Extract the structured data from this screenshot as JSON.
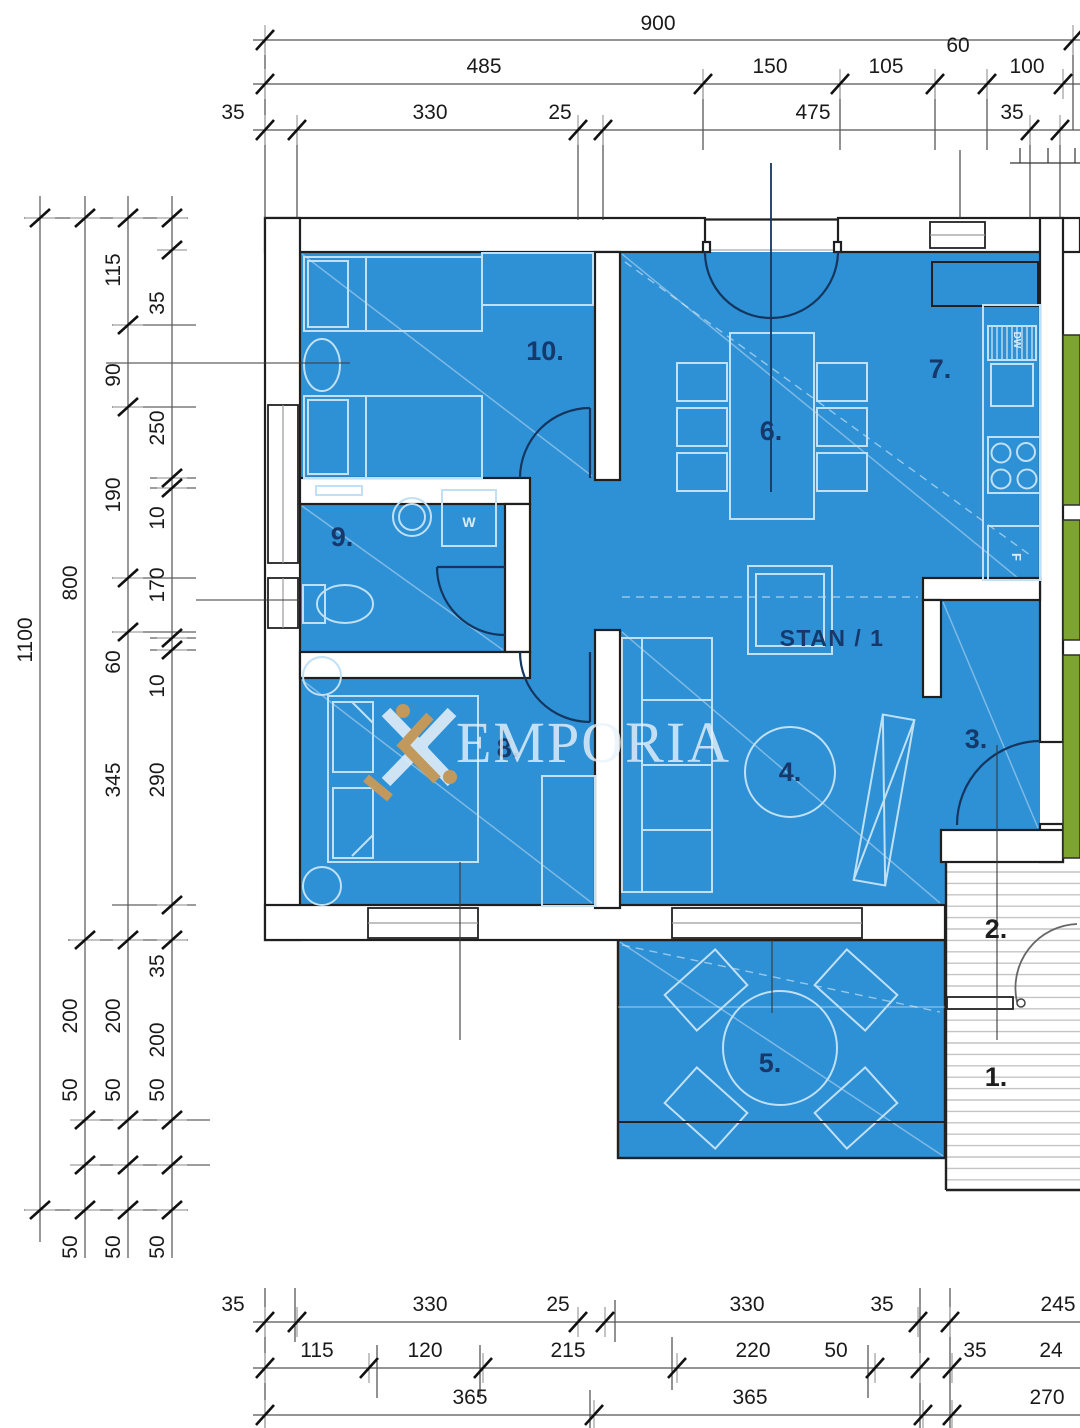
{
  "unit_label": {
    "text": "STAN / 1"
  },
  "watermark": {
    "text": "EMPORIA"
  },
  "room_labels": [
    {
      "num": "1.",
      "x": 996,
      "y": 1086,
      "color": "dark"
    },
    {
      "num": "2.",
      "x": 996,
      "y": 938,
      "color": "dark"
    },
    {
      "num": "3.",
      "x": 976,
      "y": 748,
      "color": "navy"
    },
    {
      "num": "4.",
      "x": 790,
      "y": 781,
      "color": "navy"
    },
    {
      "num": "5.",
      "x": 770,
      "y": 1072,
      "color": "navy"
    },
    {
      "num": "6.",
      "x": 771,
      "y": 440,
      "color": "navy"
    },
    {
      "num": "7.",
      "x": 940,
      "y": 378,
      "color": "navy"
    },
    {
      "num": "8.",
      "x": 508,
      "y": 757,
      "color": "navy"
    },
    {
      "num": "9.",
      "x": 342,
      "y": 546,
      "color": "navy"
    },
    {
      "num": "10.",
      "x": 545,
      "y": 360,
      "color": "navy"
    }
  ],
  "fixture_labels": [
    {
      "t": "W",
      "x": 469,
      "y": 527,
      "rot": 0,
      "size": 14
    },
    {
      "t": "DW",
      "x": 1014,
      "y": 340,
      "rot": 90,
      "size": 10
    },
    {
      "t": "F",
      "x": 1012,
      "y": 557,
      "rot": 90,
      "size": 13
    }
  ],
  "colors": {
    "room_blue": "#2E90D5",
    "label_navy": "#16386B",
    "label_dark": "#1E1E1E",
    "neighbor_green": "#7CA42F",
    "logo_orange": "#CE9A52"
  },
  "dims": {
    "top_rows": [
      {
        "y": 40,
        "line": [
          253,
          1080
        ],
        "ticks": [
          265,
          1073
        ],
        "labels": [
          {
            "t": "900",
            "x": 658,
            "dy": -10
          }
        ]
      },
      {
        "y": 84,
        "line": [
          253,
          1080
        ],
        "ticks": [
          265,
          703,
          840,
          935,
          987,
          1063
        ],
        "labels": [
          {
            "t": "485",
            "x": 484,
            "dy": -11
          },
          {
            "t": "150",
            "x": 770,
            "dy": -11
          },
          {
            "t": "105",
            "x": 886,
            "dy": -11
          },
          {
            "t": "60",
            "x": 958,
            "dy": -32
          },
          {
            "t": "100",
            "x": 1027,
            "dy": -11
          }
        ]
      },
      {
        "y": 130,
        "line": [
          253,
          1080
        ],
        "ticks": [
          265,
          297,
          578,
          603,
          1030,
          1060
        ],
        "labels": [
          {
            "t": "35",
            "x": 233,
            "dy": -11
          },
          {
            "t": "330",
            "x": 430,
            "dy": -11
          },
          {
            "t": "25",
            "x": 560,
            "dy": -11
          },
          {
            "t": "475",
            "x": 813,
            "dy": -11
          },
          {
            "t": "35",
            "x": 1012,
            "dy": -11
          }
        ]
      }
    ],
    "left_cols": [
      {
        "x": 40,
        "line": [
          196,
          1242
        ],
        "ticks": [
          218,
          1210
        ],
        "labels": [
          {
            "t": "1100",
            "y": 640
          }
        ]
      },
      {
        "x": 85,
        "line": [
          196,
          1258
        ],
        "ticks": [
          218,
          940,
          1120,
          1165,
          1210
        ],
        "labels": [
          {
            "t": "800",
            "y": 583
          },
          {
            "t": "200",
            "y": 1016
          },
          {
            "t": "50",
            "y": 1090
          },
          {
            "t": "50",
            "y": 1247
          }
        ]
      },
      {
        "x": 128,
        "line": [
          196,
          1258
        ],
        "ticks": [
          218,
          325,
          407,
          578,
          632,
          940,
          1120,
          1165,
          1210
        ],
        "labels": [
          {
            "t": "115",
            "y": 270
          },
          {
            "t": "90",
            "y": 375
          },
          {
            "t": "190",
            "y": 495
          },
          {
            "t": "60",
            "y": 662
          },
          {
            "t": "345",
            "y": 780
          },
          {
            "t": "200",
            "y": 1016
          },
          {
            "t": "50",
            "y": 1090
          },
          {
            "t": "50",
            "y": 1247
          }
        ]
      },
      {
        "x": 172,
        "line": [
          196,
          1258
        ],
        "ticks": [
          218,
          250,
          478,
          488,
          638,
          650,
          905,
          940,
          1120,
          1165,
          1210
        ],
        "labels": [
          {
            "t": "35",
            "y": 303
          },
          {
            "t": "250",
            "y": 428
          },
          {
            "t": "10",
            "y": 518
          },
          {
            "t": "170",
            "y": 585
          },
          {
            "t": "10",
            "y": 686
          },
          {
            "t": "290",
            "y": 780
          },
          {
            "t": "35",
            "y": 966
          },
          {
            "t": "200",
            "y": 1040
          },
          {
            "t": "50",
            "y": 1090
          },
          {
            "t": "50",
            "y": 1247
          }
        ]
      }
    ],
    "bottom_rows": [
      {
        "y": 1322,
        "line": [
          253,
          1080
        ],
        "ticks": [
          265,
          297,
          578,
          605,
          918,
          950
        ],
        "labels": [
          {
            "t": "35",
            "x": 233,
            "dy": -11
          },
          {
            "t": "330",
            "x": 430,
            "dy": -11
          },
          {
            "t": "25",
            "x": 558,
            "dy": -11
          },
          {
            "t": "330",
            "x": 747,
            "dy": -11
          },
          {
            "t": "35",
            "x": 882,
            "dy": -11
          },
          {
            "t": "245",
            "x": 1058,
            "dy": -11
          }
        ]
      },
      {
        "y": 1368,
        "line": [
          253,
          1080
        ],
        "ticks": [
          265,
          369,
          483,
          677,
          875,
          920,
          952
        ],
        "labels": [
          {
            "t": "115",
            "x": 317,
            "dy": -11
          },
          {
            "t": "120",
            "x": 425,
            "dy": -11
          },
          {
            "t": "215",
            "x": 568,
            "dy": -11
          },
          {
            "t": "220",
            "x": 753,
            "dy": -11
          },
          {
            "t": "50",
            "x": 836,
            "dy": -11
          },
          {
            "t": "35",
            "x": 975,
            "dy": -11
          },
          {
            "t": "24",
            "x": 1051,
            "dy": -11
          }
        ]
      },
      {
        "y": 1415,
        "line": [
          253,
          1080
        ],
        "ticks": [
          265,
          594,
          923,
          952
        ],
        "labels": [
          {
            "t": "365",
            "x": 470,
            "dy": -11
          },
          {
            "t": "365",
            "x": 750,
            "dy": -11
          },
          {
            "t": "270",
            "x": 1047,
            "dy": -11
          }
        ]
      }
    ]
  }
}
